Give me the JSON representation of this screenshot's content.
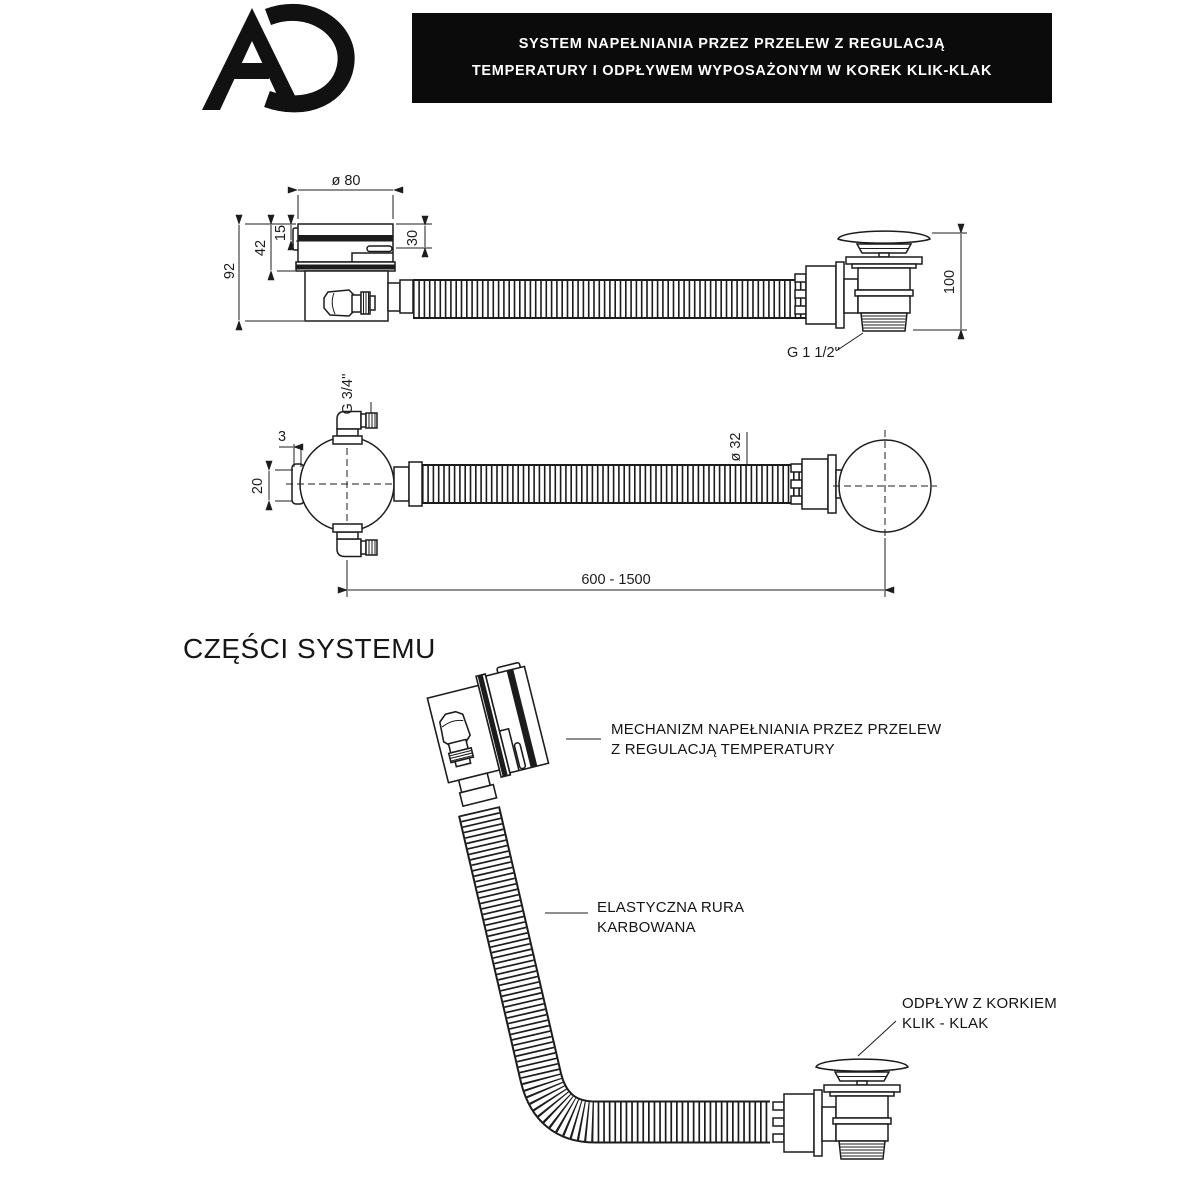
{
  "header": {
    "logo_text": "AD",
    "banner_line1": "SYSTEM NAPEŁNIANIA PRZEZ PRZELEW Z REGULACJĄ",
    "banner_line2": "TEMPERATURY I ODPŁYWEM WYPOSAŻONYM W KOREK KLIK-KLAK"
  },
  "section_title": "CZĘŚCI SYSTEMU",
  "colors": {
    "ink": "#1c1c1c",
    "banner_bg": "#0b0b0b",
    "banner_text": "#ffffff"
  },
  "top_view": {
    "dims": {
      "cap_diameter": "ø 80",
      "total_height": "92",
      "upper_height": "42",
      "cap_height": "15",
      "right_height": "30",
      "drain_height": "100",
      "drain_thread": "G 1 1/2''"
    }
  },
  "front_view": {
    "dims": {
      "inlet_thread": "G 3/4''",
      "rim_offset": "3",
      "rim_depth": "20",
      "hose_diameter": "ø 32",
      "hose_length": "600 - 1500"
    }
  },
  "parts": {
    "labels": [
      {
        "line1": "MECHANIZM NAPEŁNIANIA PRZEZ PRZELEW",
        "line2": "Z REGULACJĄ TEMPERATURY"
      },
      {
        "line1": "ELASTYCZNA RURA",
        "line2": "KARBOWANA"
      },
      {
        "line1": "ODPŁYW Z KORKIEM",
        "line2": "KLIK - KLAK"
      }
    ]
  }
}
